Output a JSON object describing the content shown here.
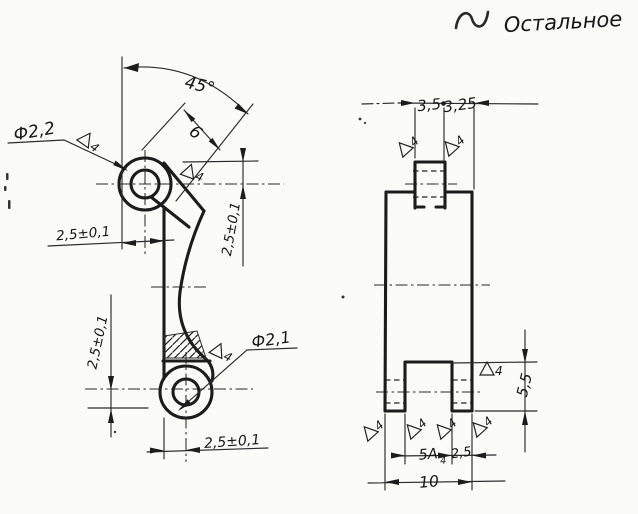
{
  "note": {
    "roughness_symbol": "∼",
    "text": "Остальное"
  },
  "front_view": {
    "dims": {
      "angle": "45°",
      "lug_offset": "6",
      "top_hole_dia": "Ф2,2",
      "bottom_hole_dia": "Ф2,1",
      "top_offset": "2,5±0,1",
      "right_offset": "2,5±0,1",
      "left_offset": "2,5±0,1",
      "bottom_offset": "2,5±0,1"
    }
  },
  "side_view": {
    "dims": {
      "tab_width": "3,5",
      "shoulder_width": "3,25",
      "slot_depth": "5,5",
      "slot_width": "5А",
      "slot_fit_subscript": "4",
      "leg_width": "2,5",
      "overall_width": "10"
    }
  },
  "roughness_grade": "4",
  "colors": {
    "ink": "#1c1c1c",
    "paper": "#fbfbf8"
  }
}
